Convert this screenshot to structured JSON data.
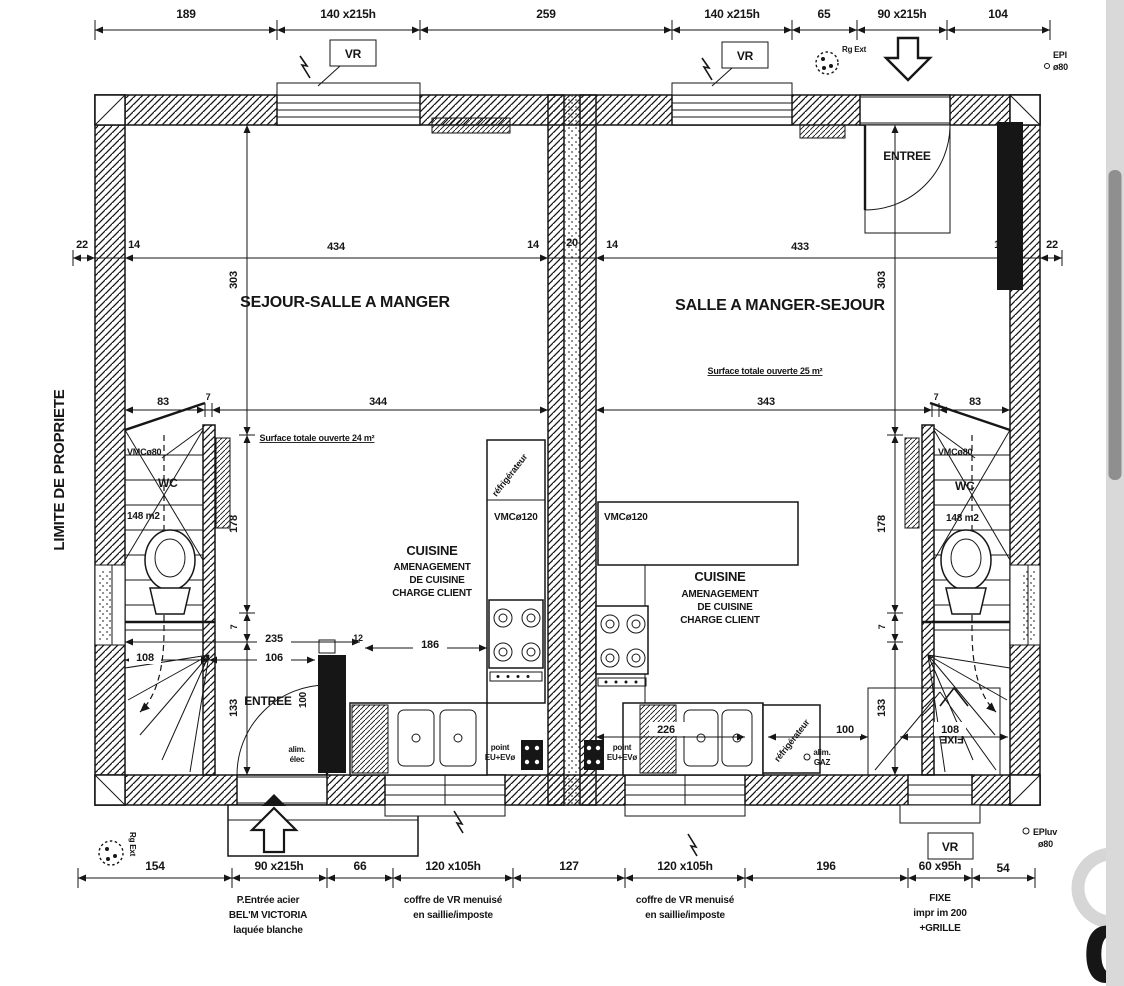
{
  "colors": {
    "ink": "#161616",
    "paper": "#ffffff",
    "scrollbar_track": "#d9d9d9",
    "scrollbar_thumb": "#8f8f8f",
    "watermark": "#d6d6d6"
  },
  "dims": {
    "top": [
      "189",
      "140 x215h",
      "259",
      "140 x215h",
      "65",
      "90 x215h",
      "104"
    ],
    "wall_row": [
      "22",
      "14",
      "434",
      "14",
      "20",
      "14",
      "433",
      "14",
      "22"
    ],
    "mid_row": [
      "83",
      "7",
      "344",
      "343",
      "7",
      "83"
    ],
    "vertical_left": [
      "303",
      "178",
      "7",
      "133"
    ],
    "vertical_right": [
      "303",
      "178",
      "7",
      "133"
    ],
    "bottom": [
      "154",
      "90 x215h",
      "66",
      "120 x105h",
      "127",
      "120 x105h",
      "196",
      "60 x95h",
      "54"
    ],
    "misc": {
      "d235": "235",
      "d106": "106",
      "d108_left": "108",
      "d100_left": "100",
      "d12": "12",
      "d21": "21",
      "d186": "186",
      "d226": "226",
      "d100_right": "100",
      "d108_right": "108"
    }
  },
  "left_unit": {
    "title": "SEJOUR-SALLE A MANGER",
    "surface_note": "Surface totale ouverte 24 m²",
    "kitchen_lines": [
      "CUISINE",
      "AMENAGEMENT",
      "DE CUISINE",
      "CHARGE CLIENT"
    ],
    "entree": "ENTREE",
    "wc": "WC",
    "wc_area": "148 m2",
    "vmc80": "VMCø80",
    "vmc120": "VMCø120",
    "fridge": "réfrigérateur",
    "drain_line1": "point",
    "drain_line2": "EU+EVø",
    "gtl": "GTL",
    "alim_line1": "alim.",
    "alim_line2": "élec"
  },
  "right_unit": {
    "title": "SALLE A MANGER-SEJOUR",
    "surface_note": "Surface totale ouverte 25 m²",
    "kitchen_lines": [
      "CUISINE",
      "AMENAGEMENT",
      "DE CUISINE",
      "CHARGE CLIENT"
    ],
    "entree": "ENTREE",
    "wc": "WC",
    "wc_area": "148 m2",
    "vmc80": "VMCø80",
    "vmc120": "VMCø120",
    "fridge": "réfrigérateur",
    "drain_line1": "point",
    "drain_line2": "EU+EVø",
    "gtl": "GTL",
    "gaz_line1": "alim.",
    "gaz_line2": "GAZ",
    "fixe": "FIXE"
  },
  "annotations": {
    "vr": "VR",
    "limite": "LIMITE DE PROPRIETE",
    "rg_ext": "Rg Ext",
    "ep_top_label": "EPl",
    "ep_top_dia": "ø80",
    "epluv_label": "EPluv",
    "epluv_dia": "ø80",
    "door_note": [
      "P.Entrée acier",
      "BEL'M VICTORIA",
      "laquée blanche"
    ],
    "coffre_note": [
      "coffre de VR menuisé",
      "en saillie/imposte"
    ],
    "fixe_note": [
      "FIXE",
      "impr im 200",
      "+GRILLE"
    ],
    "watermark": "d"
  }
}
